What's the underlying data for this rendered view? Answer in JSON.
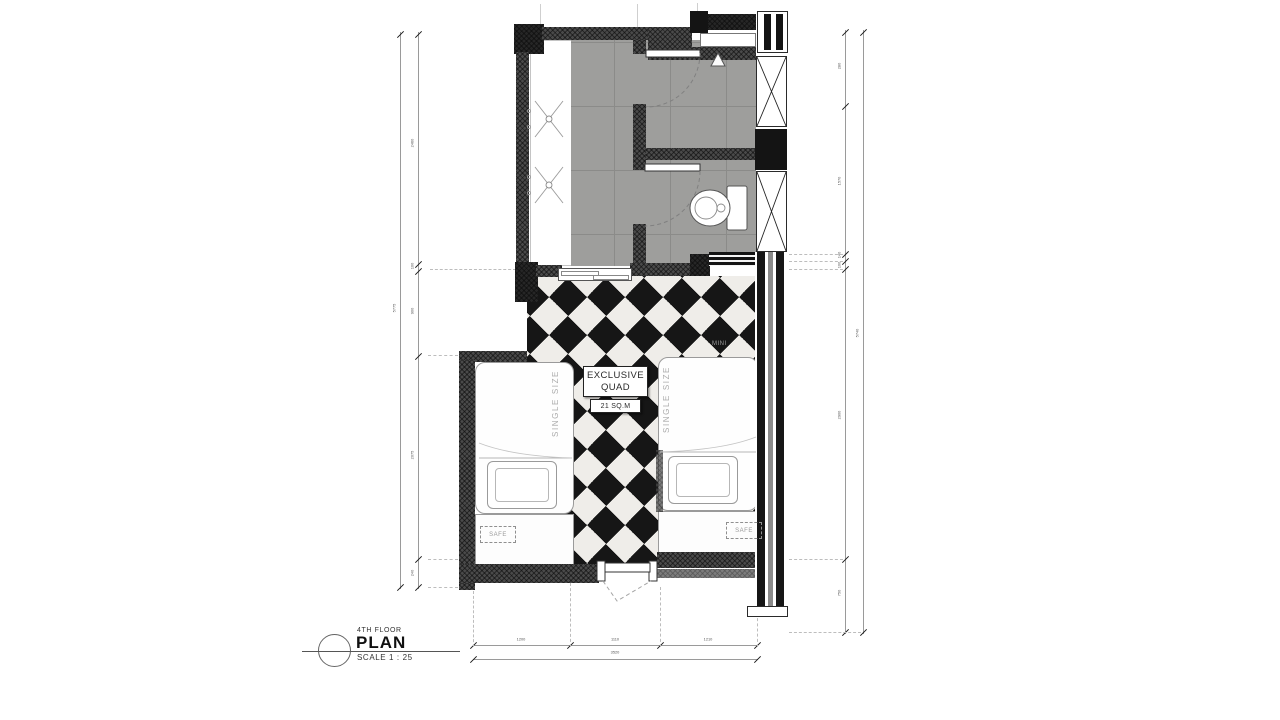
{
  "title_block": {
    "floor_label": "4TH FLOOR",
    "title": "PLAN",
    "scale_label": "SCALE 1 : 25"
  },
  "room_label": {
    "line1": "EXCLUSIVE",
    "line2": "QUAD",
    "area": "21 SQ.M"
  },
  "labels": {
    "bed_left_size": "SINGLE SIZE",
    "bed_right_size": "SINGLE SIZE",
    "safe_left": "SAFE",
    "safe_right": "SAFE",
    "minibar": "MINI"
  },
  "dimensions": {
    "bottom": {
      "segments": [
        "1200",
        "1110",
        "1210"
      ],
      "total": "3520"
    },
    "left": {
      "segments": [
        "2460",
        "100",
        "900",
        "2075",
        "240"
      ],
      "total": "5775"
    },
    "right": {
      "segments": [
        "280",
        "1570",
        "140",
        "100",
        "2900",
        "750"
      ],
      "total": "5740"
    }
  },
  "colors": {
    "wall": "#4a4a4a",
    "wall_dark": "#262626",
    "tile_floor": "#9e9e9c",
    "checker_black": "#161616",
    "checker_white": "#efede9",
    "line": "#9a9a9a"
  }
}
